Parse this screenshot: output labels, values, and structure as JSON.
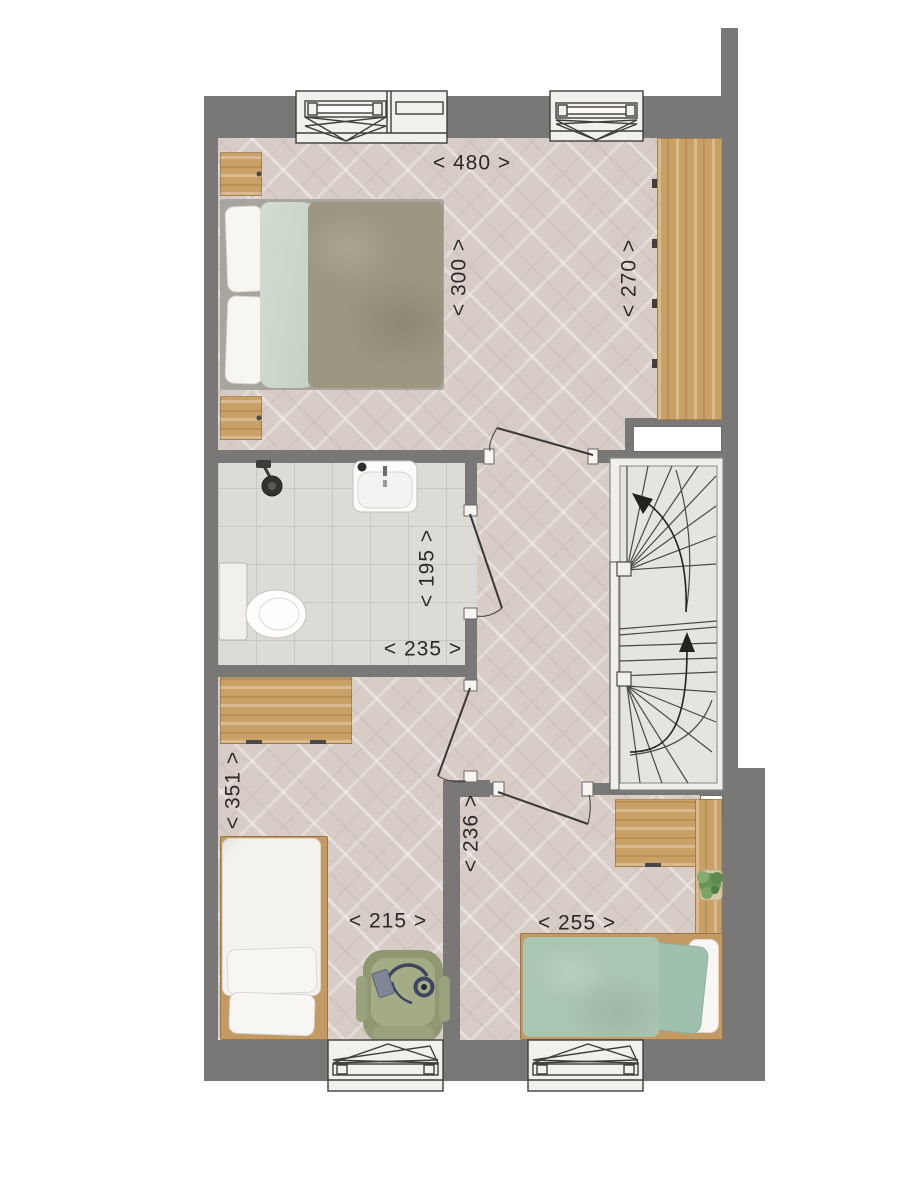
{
  "plan": {
    "type": "floor-plan-first-floor",
    "dimensions": {
      "master_width": "< 480 >",
      "master_depth": "< 300 >",
      "wardrobe_wall": "< 270 >",
      "bathroom_depth": "< 195 >",
      "bathroom_width": "< 235 >",
      "bedroom2_depth": "< 351 >",
      "bedroom2_width": "< 215 >",
      "bedroom3_depth": "< 236 >",
      "bedroom3_width": "< 255 >"
    },
    "colors": {
      "wall": "#7a7876",
      "floor": "#d7ccc6",
      "bathroom_tile": "#dcdbd7",
      "wood": "#c9a066",
      "duvet_olive": "#9b9780",
      "sheet_sage": "#c9d3c7",
      "bed_green": "#a9c6b2",
      "chair_green": "#8f9873",
      "plant_green": "#6b9458",
      "linework": "#3f3e3c"
    }
  }
}
